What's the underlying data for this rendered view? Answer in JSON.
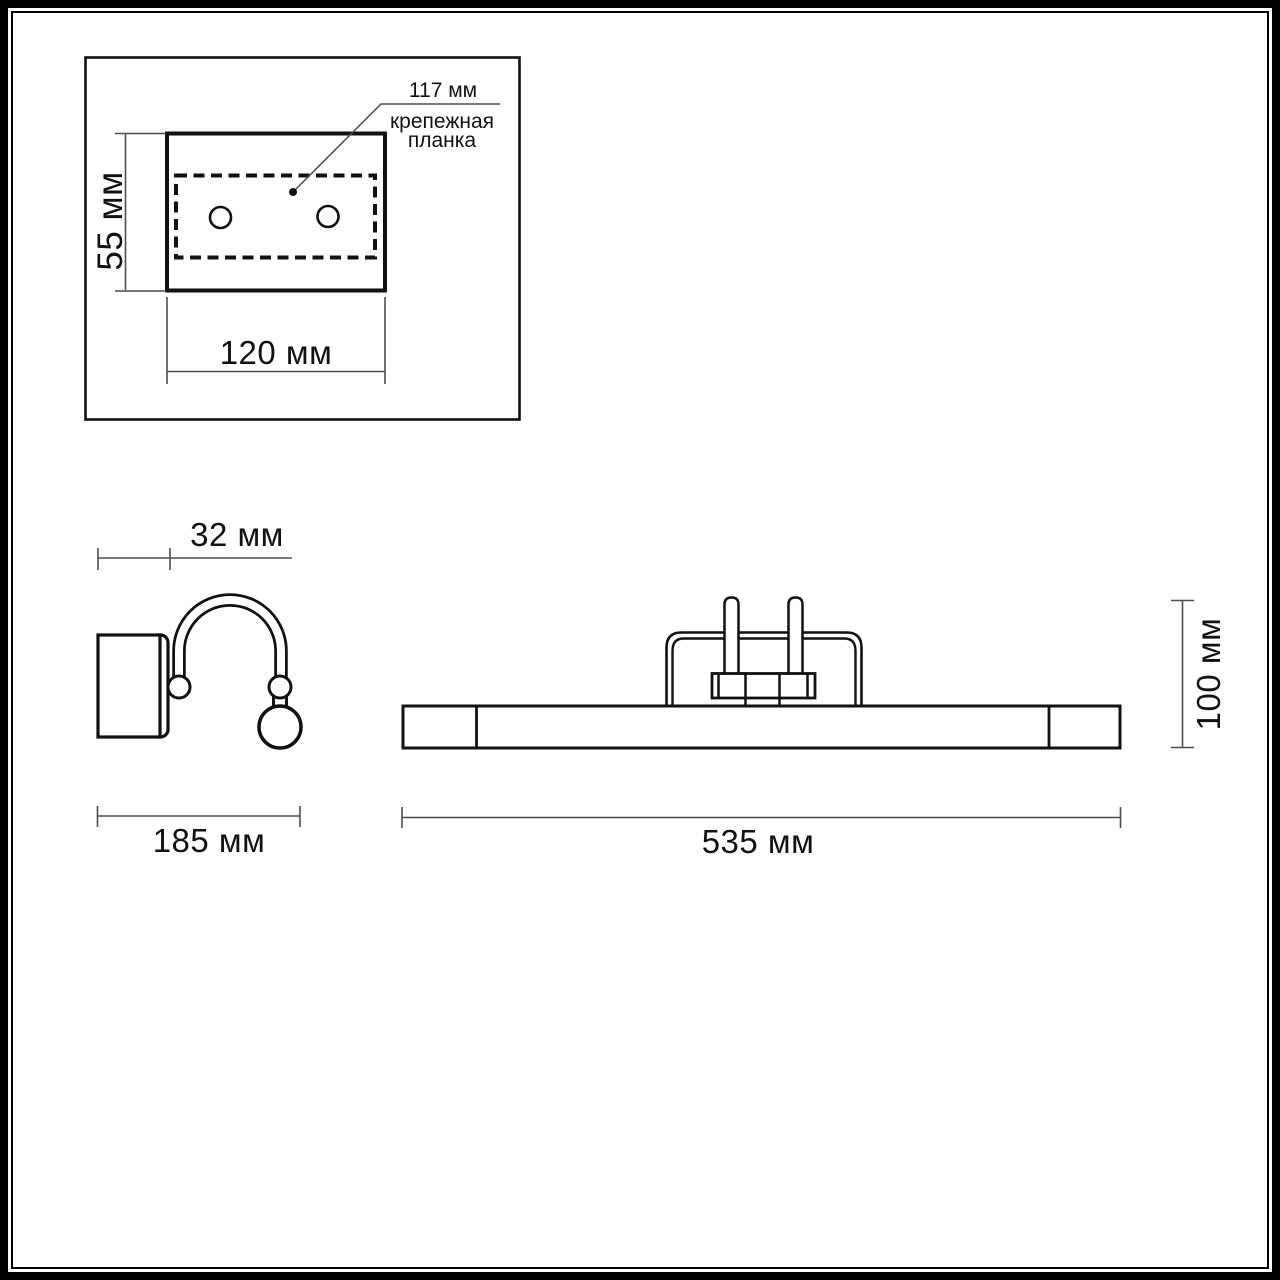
{
  "colors": {
    "drawing_line": "#111111",
    "dimension_line": "#4d4d4d",
    "text": "#111111",
    "background": "#ffffff",
    "frame": "#000000"
  },
  "mounting_plate_view": {
    "callout_dimension": "117 мм",
    "callout_label": [
      "крепежная",
      "планка"
    ],
    "height_dimension": "55 мм",
    "width_dimension": "120 мм"
  },
  "side_view": {
    "depth_dimension": "32 мм",
    "width_dimension": "185 мм"
  },
  "front_view": {
    "height_dimension": "100 мм",
    "width_dimension": "535 мм"
  }
}
